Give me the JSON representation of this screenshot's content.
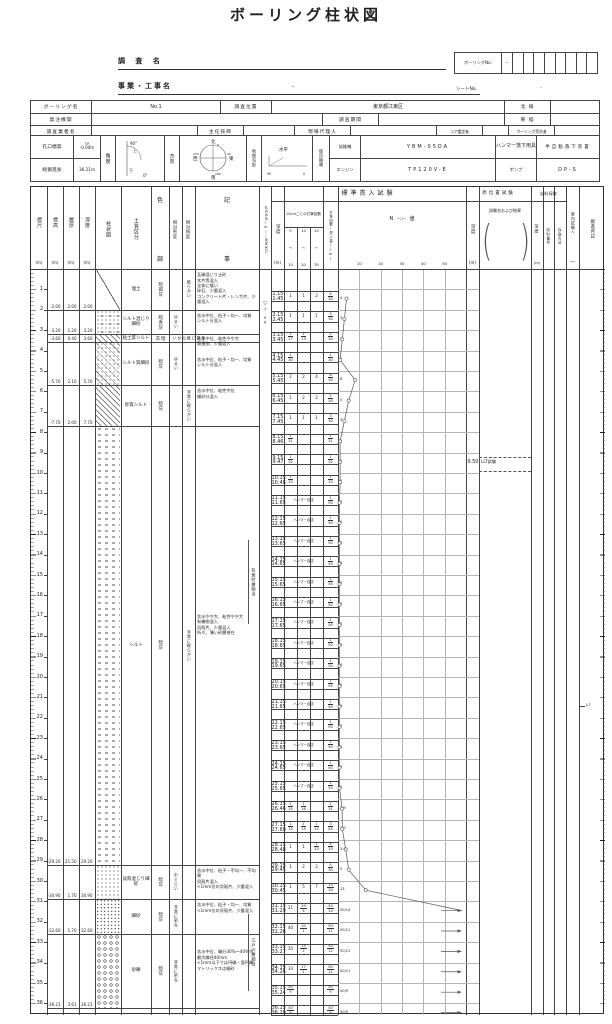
{
  "title": "ボーリング柱状図",
  "meta": {
    "survey_name_label": "調 査 名",
    "boring_no_label": "ボーリングNo.",
    "boring_no_value": "-",
    "project_label": "事業・工事名",
    "project_value": "-",
    "sheet_no_label": "シートNo.",
    "sheet_no_value": "-"
  },
  "info1": {
    "c11": "ボーリング名",
    "v11": "No.1",
    "c12": "調査位置",
    "v12": "東京都江東区",
    "c13": "北 緯",
    "v13": "",
    "c21": "発注機関",
    "v21": "",
    "c22": "調査期間",
    "v22": "",
    "c23": "東 経",
    "v23": "",
    "c31": "調査業者名",
    "v31": "",
    "c32": "主任技師",
    "v32": "",
    "c33": "現場代理人",
    "v33": "",
    "c34": "コア鑑定者",
    "v34": "",
    "c35": "ボーリング責任者",
    "v35": ""
  },
  "info2": {
    "k1": "孔口標高",
    "elev_prefix": "T.P.",
    "elev_value": "-0.00m",
    "k2": "総掘進長",
    "length_value": "36.21m",
    "angle": "角度",
    "angle_90": "90°",
    "angle_0": "0°",
    "angle_up": "上",
    "angle_down": "下",
    "dir": "方向",
    "compass": {
      "n": "北",
      "e": "東",
      "s": "南",
      "w": "西",
      "d0": "0",
      "d90": "90",
      "d180": "180",
      "d270": "270"
    },
    "slope": "地盤勾配",
    "slope_note": "水平",
    "s90": "90",
    "s0": "0",
    "machine": "使用機種",
    "drill": "試錐機",
    "drill_v": "YBM-05DA",
    "engine": "エンジン",
    "engine_v": "TP120V-E",
    "hammer": "ハンマー落下用具",
    "hammer_v": "半自動落下装置",
    "pump": "ポンプ",
    "pump_v": "DP-S"
  },
  "log": {
    "columns": {
      "scale": "標尺",
      "elev": "標高",
      "thick": "層厚",
      "depth": "深度",
      "m": "(m)",
      "column": "柱状図",
      "soil": "土質区分",
      "color": "色調",
      "density": "相対密度",
      "consistency": "相対稠度",
      "remarks": "記事",
      "water": "孔内水位(m)/測定月日",
      "spt_group": "標準貫入試験",
      "spt_depth": "深度",
      "spt_counts": "10cmごとの打撃回数",
      "ranges": [
        "0〜10",
        "10〜20",
        "20〜30"
      ],
      "spt_total": "打撃回数/貫入量(cm)",
      "nvalue": "N",
      "nvalue2": "値",
      "nvalue_marker": "─○─",
      "axis": [
        "10",
        "20",
        "30",
        "40",
        "50"
      ],
      "insitu_group": "原位置試験",
      "insitu_depth": "深度",
      "insitu_name": "試験名および結果",
      "sample_group": "試料採取",
      "sample_depth": "深度",
      "sample_no": "試料番号",
      "sample_method": "採取方法",
      "lab": "室内試験へ",
      "lab_dash": "一",
      "date": "掘進月日"
    },
    "scale_ticks": [
      1,
      2,
      3,
      4,
      5,
      6,
      7,
      8,
      9,
      10,
      11,
      12,
      13,
      14,
      15,
      16,
      17,
      18,
      19,
      20,
      21,
      22,
      23,
      24,
      25,
      26,
      27,
      28,
      29,
      30,
      31,
      32,
      33,
      34,
      35,
      36
    ],
    "layers": [
      {
        "from": 0,
        "to": 2.0,
        "elev": "-2.00",
        "thick": "2.00",
        "depth": "2.00",
        "soil": "埋土",
        "color": "暗褐灰",
        "cons": "軟らかい",
        "pattern": "fill",
        "remarks": "瓦礫混じり土砂\n木片等混入\n全体に緩い\n砕石、少量混入\nコンクリート片・レンガ片、少量混入",
        "remarks_at": 0.15
      },
      {
        "from": 2.0,
        "to": 3.2,
        "elev": "-3.20",
        "thick": "1.20",
        "depth": "3.20",
        "soil": "シルト混じり細砂",
        "color": "暗青灰",
        "dens": "ゆるい",
        "pattern": "sandsilt",
        "remarks": "含水中位、粒子・均一、均質\nシルト分混入",
        "remarks_at": 2.15
      },
      {
        "from": 3.2,
        "to": 3.6,
        "elev": "-3.60",
        "thick": "0.40",
        "depth": "3.60",
        "soil": "粘土質シルト",
        "color": "暗灰",
        "cons": "非常に軟らかい",
        "pattern": "hatch",
        "remarks": "含水中位、粘性やや大\n腐植物、少量混入",
        "remarks_at": 3.28
      },
      {
        "from": 3.6,
        "to": 5.7,
        "elev": "-5.70",
        "thick": "2.10",
        "depth": "5.70",
        "soil": "シルト質細砂",
        "color": "暗灰",
        "dens": "ゆるい",
        "pattern": "hatchdots",
        "remarks": "含水中位、粒子・均一、均質\nシルト分混入",
        "remarks_at": 4.3
      },
      {
        "from": 5.7,
        "to": 7.7,
        "elev": "-7.70",
        "thick": "2.00",
        "depth": "7.70",
        "soil": "砂質シルト",
        "color": "暗灰",
        "cons": "非常に軟らかい",
        "pattern": "hatch",
        "remarks": "含水中位、粘性中位\n細砂分混入",
        "remarks_at": 5.85
      },
      {
        "from": 7.7,
        "to": 29.2,
        "elev": "-29.20",
        "thick": "21.50",
        "depth": "29.20",
        "soil": "シルト",
        "color": "暗灰",
        "cons": "非常に軟らかい",
        "pattern": "silt",
        "remarks": "含水やや大、粘性やや大\n有機物混入\n貝殻片、少量混入\n所々、薄い砂層挟在",
        "remarks_at": 16.9
      },
      {
        "from": 29.2,
        "to": 30.9,
        "elev": "-30.90",
        "thick": "1.70",
        "depth": "30.90",
        "soil": "貝殻混じり細砂",
        "color": "暗灰",
        "dens": "中ぐらい",
        "pattern": "sand",
        "remarks": "含水中位、粒子・不均一、不均質\n貝殻片混入\n<1mm位の貝殻片、少量混入",
        "remarks_at": 29.35
      },
      {
        "from": 30.9,
        "to": 32.6,
        "elev": "-32.60",
        "thick": "1.70",
        "depth": "32.60",
        "soil": "細砂",
        "color": "暗灰",
        "dens": "非常に密な",
        "pattern": "sand2",
        "remarks": "含水中位、粒子・均一、均質\n<1mm位の貝殻片、少量混入",
        "remarks_at": 31.05
      },
      {
        "from": 32.6,
        "to": 36.21,
        "elev": "-36.21",
        "thick": "3.61",
        "depth": "36.21",
        "soil": "砂礫",
        "color": "暗灰",
        "dens": "非常に密な",
        "pattern": "gravel",
        "remarks": "含水中位、礫分30%〜40%位\n最大礫径40mm\n<1mm以下では円礫・亜円礫\nマトリックスは細砂",
        "remarks_at": 33.35
      }
    ],
    "annotations": [
      {
        "text": "有楽町層相当",
        "from": 13.3,
        "to": 17.4
      },
      {
        "text": "江戸川層相当",
        "from": 31.6,
        "to": 35.4
      }
    ],
    "water_level": {
      "symbol": "▽",
      "value": "1.96",
      "depth": 1.5
    },
    "spt_rows": [
      {
        "d": "1.15",
        "d2": "1.45",
        "v": 1.15,
        "c": [
          "1",
          "1",
          "2"
        ],
        "t": "4/30",
        "n": "4",
        "N": 4
      },
      {
        "d": "2.15",
        "d2": "2.45",
        "v": 2.15,
        "c": [
          "1",
          "1",
          "1"
        ],
        "t": "3/30",
        "n": "3",
        "N": 3
      },
      {
        "d": "3.15",
        "d2": "3.45",
        "v": 3.15,
        "c": [
          "1/17",
          "1/13",
          ""
        ],
        "t": "2/30",
        "n": "2",
        "N": 2
      },
      {
        "d": "4.15",
        "d2": "4.45",
        "v": 4.15,
        "c": [
          "1/30",
          "",
          ""
        ],
        "t": "1/30",
        "n": "1",
        "N": 1
      },
      {
        "d": "5.15",
        "d2": "5.45",
        "v": 5.15,
        "c": [
          "2",
          "2",
          "4"
        ],
        "t": "8/30",
        "n": "8",
        "N": 8
      },
      {
        "d": "6.15",
        "d2": "6.45",
        "v": 6.15,
        "c": [
          "1",
          "2",
          "2"
        ],
        "t": "5/30",
        "n": "5",
        "N": 5
      },
      {
        "d": "7.15",
        "d2": "7.45",
        "v": 7.15,
        "c": [
          "1",
          "1",
          "1"
        ],
        "t": "3/30",
        "n": "3",
        "N": 3
      },
      {
        "d": "8.15",
        "d2": "8.46",
        "v": 8.15,
        "c": [
          "1/31",
          "",
          ""
        ],
        "t": "1/31",
        "n": "1",
        "N": 1
      },
      {
        "d": "9.15",
        "d2": "9.47",
        "v": 9.15,
        "c": [
          "1/32",
          "",
          ""
        ],
        "t": "1/32",
        "n": "1",
        "N": 1
      },
      {
        "d": "10.15",
        "d2": "10.48",
        "v": 10.15,
        "c": [
          "1/33",
          "",
          ""
        ],
        "t": "1/33",
        "n": "1",
        "N": 1
      },
      {
        "d": "11.15",
        "d2": "11.65",
        "v": 11.15,
        "label": "ハンマー自沈",
        "t": "1/50",
        "n": "0",
        "N": 0
      },
      {
        "d": "12.15",
        "d2": "12.65",
        "v": 12.15,
        "label": "ハンマー自沈",
        "t": "1/50",
        "n": "0",
        "N": 0
      },
      {
        "d": "13.15",
        "d2": "13.65",
        "v": 13.15,
        "label": "ハンマー自沈",
        "t": "1/50",
        "n": "0",
        "N": 0
      },
      {
        "d": "14.15",
        "d2": "14.65",
        "v": 14.15,
        "label": "ハンマー自沈",
        "t": "1/50",
        "n": "0",
        "N": 0
      },
      {
        "d": "15.15",
        "d2": "15.65",
        "v": 15.15,
        "label": "ハンマー自沈",
        "t": "1/50",
        "n": "0",
        "N": 0
      },
      {
        "d": "16.15",
        "d2": "16.65",
        "v": 16.15,
        "label": "ハンマー自沈",
        "t": "1/50",
        "n": "0",
        "N": 0
      },
      {
        "d": "17.15",
        "d2": "17.65",
        "v": 17.15,
        "label": "ハンマー自沈",
        "t": "1/50",
        "n": "0",
        "N": 0
      },
      {
        "d": "18.15",
        "d2": "18.65",
        "v": 18.15,
        "label": "ハンマー自沈",
        "t": "1/50",
        "n": "0",
        "N": 0
      },
      {
        "d": "19.15",
        "d2": "19.65",
        "v": 19.15,
        "label": "ハンマー自沈",
        "t": "1/50",
        "n": "0",
        "N": 0
      },
      {
        "d": "20.15",
        "d2": "20.65",
        "v": 20.15,
        "label": "ハンマー自沈",
        "t": "1/50",
        "n": "0",
        "N": 0
      },
      {
        "d": "21.15",
        "d2": "21.65",
        "v": 21.15,
        "label": "ハンマー自沈",
        "t": "1/50",
        "n": "0",
        "N": 0
      },
      {
        "d": "22.15",
        "d2": "22.65",
        "v": 22.15,
        "label": "ハンマー自沈",
        "t": "1/50",
        "n": "0",
        "N": 0
      },
      {
        "d": "23.15",
        "d2": "23.65",
        "v": 23.15,
        "label": "ハンマー自沈",
        "t": "1/50",
        "n": "0",
        "N": 0
      },
      {
        "d": "24.15",
        "d2": "24.65",
        "v": 24.15,
        "label": "ハンマー自沈",
        "t": "1/50",
        "n": "0",
        "N": 0
      },
      {
        "d": "25.15",
        "d2": "25.65",
        "v": 25.15,
        "label": "ハンマー自沈",
        "t": "1/50",
        "n": "0",
        "N": 0
      },
      {
        "d": "26.15",
        "d2": "26.46",
        "v": 26.15,
        "c": [
          "1/15",
          "1/16",
          ""
        ],
        "t": "2/31",
        "n": "1.9",
        "N": 1.9
      },
      {
        "d": "27.15",
        "d2": "27.60",
        "v": 27.15,
        "c": [
          "1/15",
          "1/15",
          "1/15"
        ],
        "t": "3/45",
        "n": "2.0",
        "N": 2
      },
      {
        "d": "28.15",
        "d2": "28.48",
        "v": 28.15,
        "c": [
          "1",
          "1",
          "2/13"
        ],
        "t": "4/33",
        "n": "3.6",
        "N": 3.6
      },
      {
        "d": "29.15",
        "d2": "29.45",
        "v": 29.15,
        "c": [
          "1",
          "2",
          "2"
        ],
        "t": "5/30",
        "n": "5",
        "N": 5
      },
      {
        "d": "30.15",
        "d2": "30.45",
        "v": 30.15,
        "c": [
          "1",
          "5",
          "7"
        ],
        "t": "13/30",
        "n": "13",
        "N": 13
      },
      {
        "d": "31.15",
        "d2": "31.29",
        "v": 31.15,
        "c": [
          "21",
          "29/4",
          ""
        ],
        "t": "50/14",
        "n": "50/14",
        "N": 60,
        "over": true
      },
      {
        "d": "32.15",
        "d2": "32.26",
        "v": 32.15,
        "c": [
          "40",
          "10/1",
          ""
        ],
        "t": "50/11",
        "n": "50/11",
        "N": 60,
        "over": true
      },
      {
        "d": "33.15",
        "d2": "33.27",
        "v": 33.15,
        "c": [
          "35",
          "15/2",
          ""
        ],
        "t": "50/12",
        "n": "50/12",
        "N": 60,
        "over": true
      },
      {
        "d": "34.15",
        "d2": "34.26",
        "v": 34.15,
        "c": [
          "33",
          "17/1",
          ""
        ],
        "t": "50/11",
        "n": "50/11",
        "N": 60,
        "over": true
      },
      {
        "d": "35.15",
        "d2": "35.24",
        "v": 35.15,
        "c": [
          "50/9",
          "",
          ""
        ],
        "t": "50/9",
        "n": "50/9",
        "N": 60,
        "over": true
      },
      {
        "d": "36.15",
        "d2": "36.20",
        "v": 36.15,
        "c": [
          "50/5",
          "",
          ""
        ],
        "t": "50/5",
        "n": "50/5",
        "N": 60,
        "over": true
      }
    ],
    "insitu_test": {
      "name": "LLT試験",
      "depth_label": "9.50",
      "from": 9.2,
      "to": 9.9
    },
    "date_mark": {
      "text": "1/7",
      "depth": 21.4
    }
  }
}
